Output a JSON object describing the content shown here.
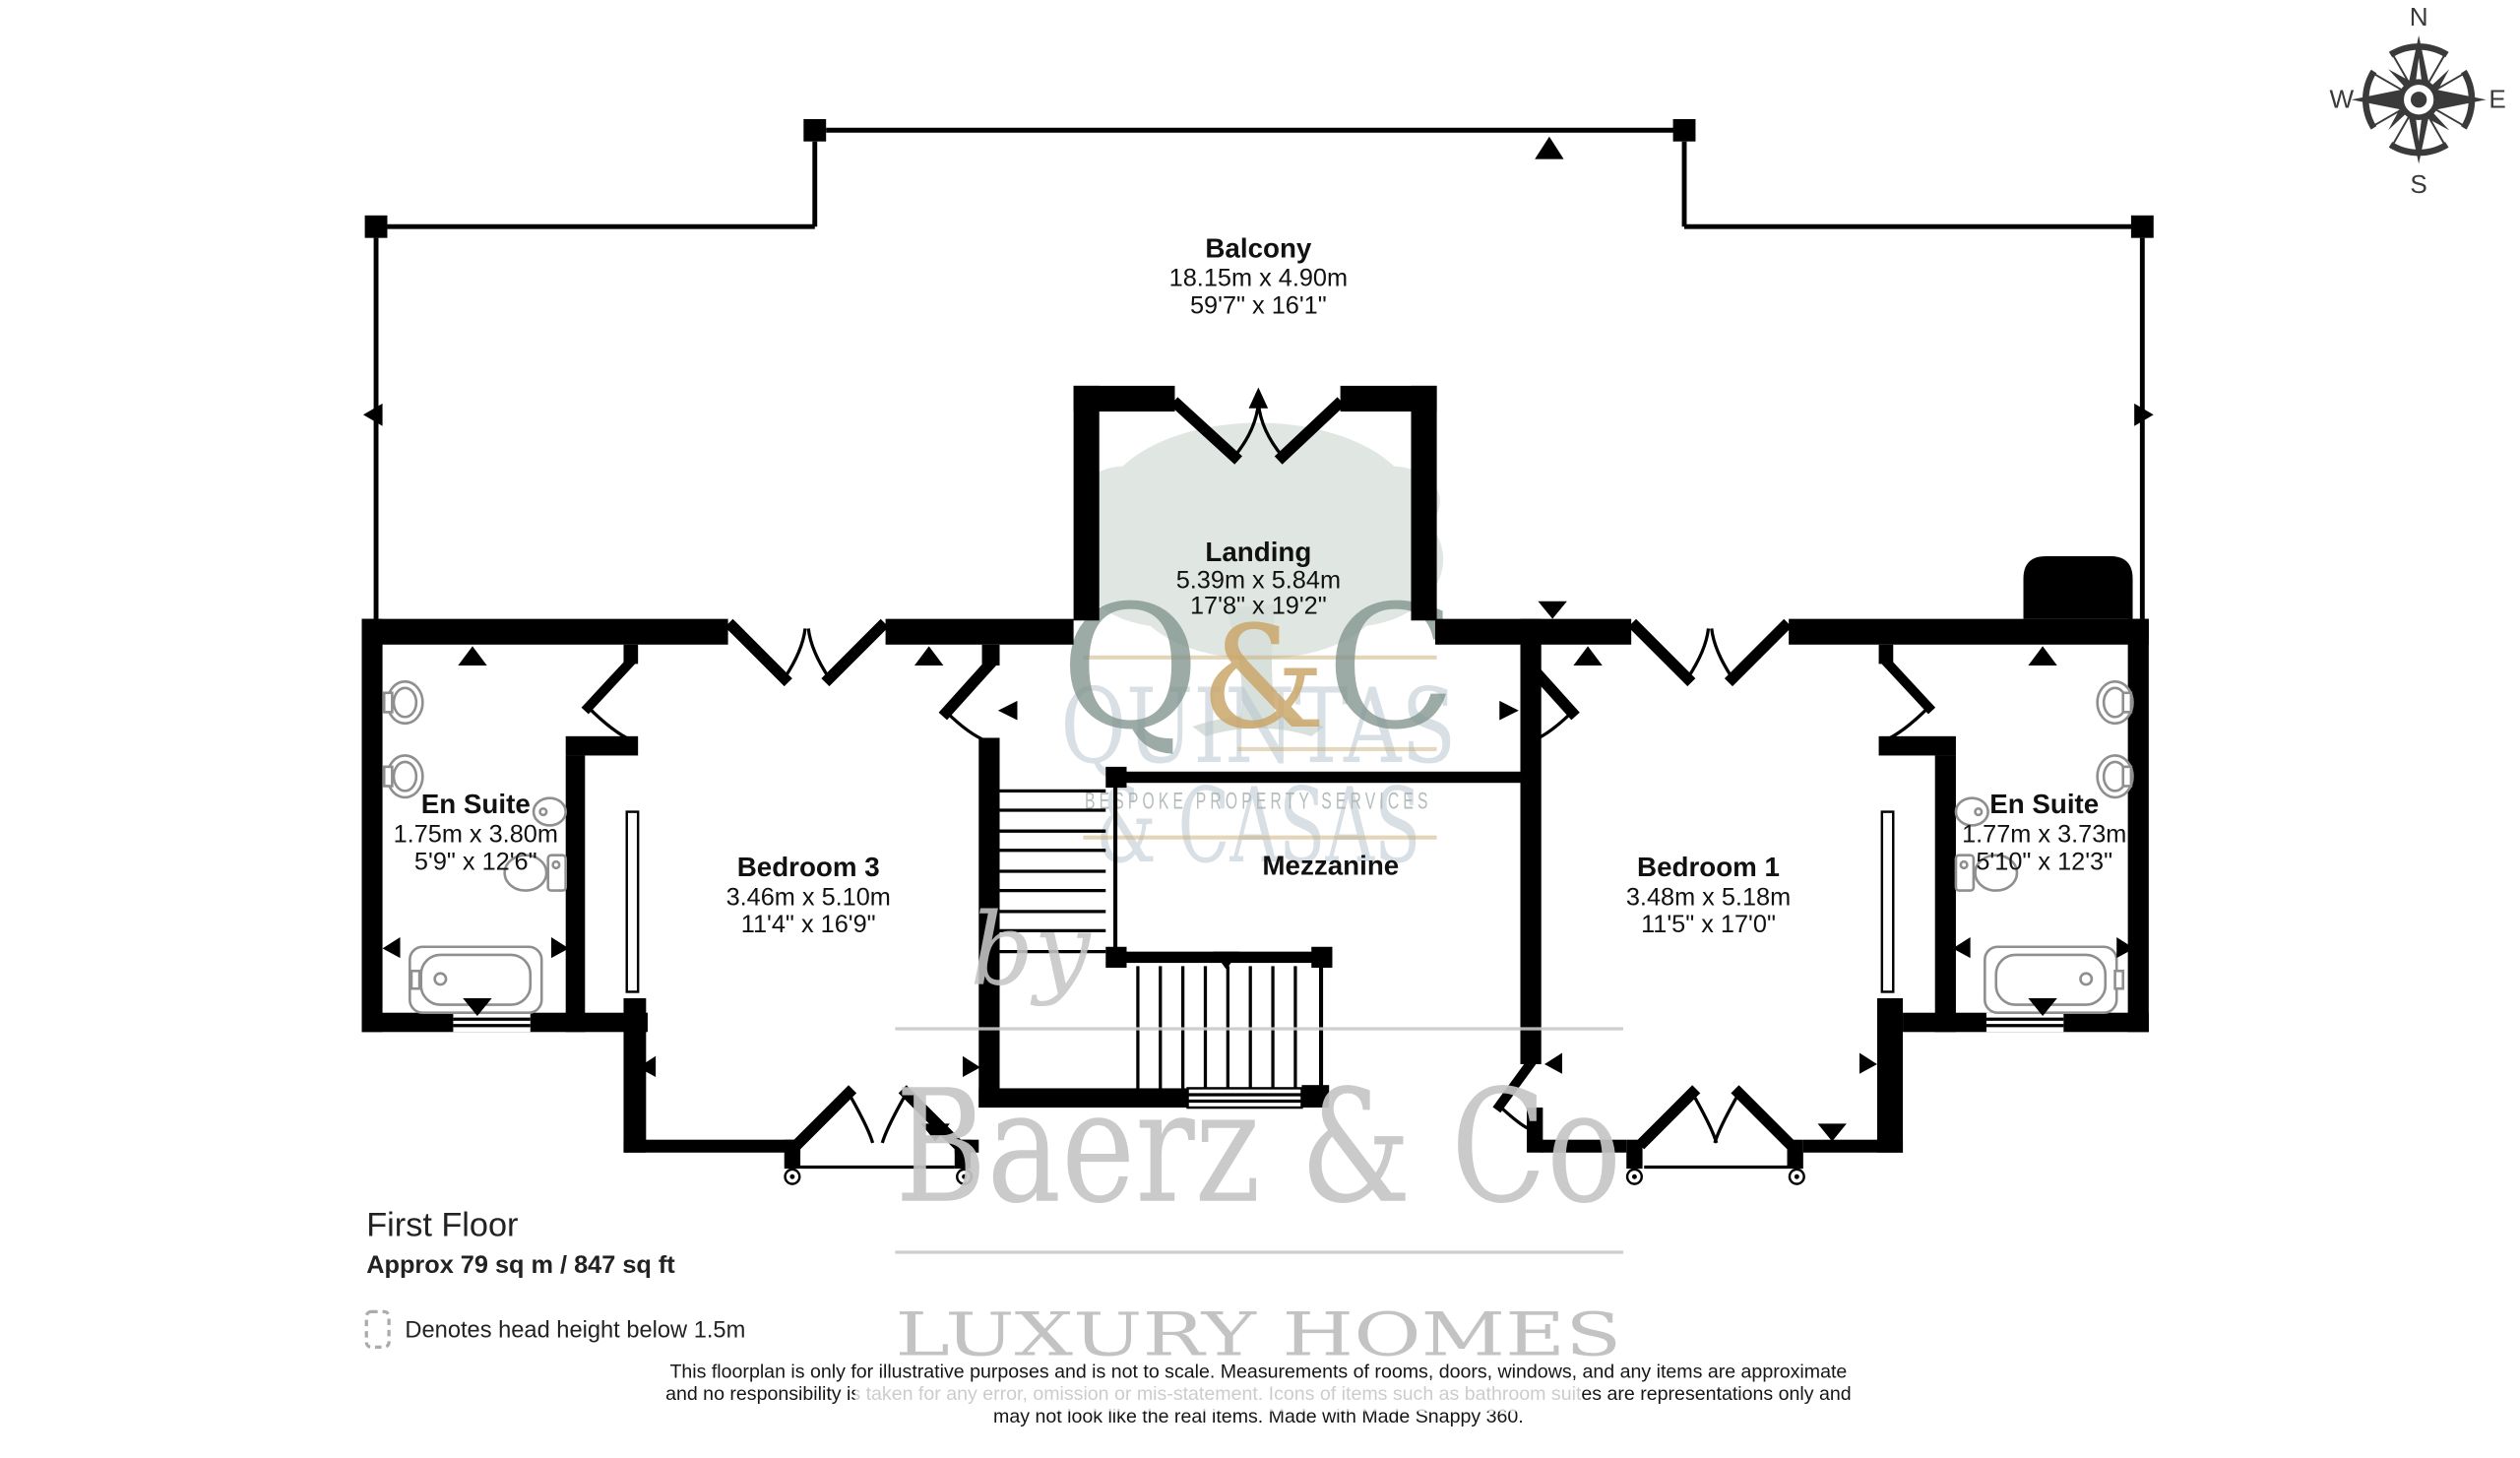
{
  "plan": {
    "title": "First Floor",
    "area": "Approx 79 sq m / 847 sq ft",
    "legend_label": "Denotes head height below 1.5m"
  },
  "compass": {
    "north": "N",
    "east": "E",
    "south": "S",
    "west": "W"
  },
  "rooms": {
    "balcony": {
      "name": "Balcony",
      "size_metric": "18.15m x 4.90m",
      "size_imperial": "59'7\" x 16'1\""
    },
    "landing": {
      "name": "Landing",
      "size_metric": "5.39m x 5.84m",
      "size_imperial": "17'8\" x 19'2\""
    },
    "bedroom3": {
      "name": "Bedroom 3",
      "size_metric": "3.46m x 5.10m",
      "size_imperial": "11'4\" x 16'9\""
    },
    "bedroom1": {
      "name": "Bedroom 1",
      "size_metric": "3.48m x 5.18m",
      "size_imperial": "11'5\" x 17'0\""
    },
    "ensuite_left": {
      "name": "En Suite",
      "size_metric": "1.75m x 3.80m",
      "size_imperial": "5'9\" x 12'6\""
    },
    "ensuite_right": {
      "name": "En Suite",
      "size_metric": "1.77m x 3.73m",
      "size_imperial": "5'10\" x 12'3\""
    },
    "mezzanine": {
      "name": "Mezzanine"
    }
  },
  "watermark": {
    "monogram_q": "Q",
    "monogram_amp": "&",
    "monogram_c": "C",
    "company_line1": "QUINTAS",
    "company_line2": "& CASAS",
    "tagline": "BESPOKE PROPERTY SERVICES",
    "by": "by",
    "brand": "Baerz & Co",
    "brand_tagline": "LUXURY HOMES"
  },
  "disclaimer": {
    "line1": "This floorplan is only for illustrative purposes and is not to scale. Measurements of rooms, doors, windows, and any items are approximate",
    "line2": "and no responsibility is taken for any error, omission or mis-statement. Icons of items such as bathroom suites are representations only and",
    "line3": "may not look like the real items. Made with Made Snappy 360."
  },
  "colors": {
    "wall": "#000000",
    "monogram_letters": "#7e9089",
    "monogram_amp": "#c7a163",
    "backdrop_blue": "#b3c2cd",
    "tree_green": "#c3cfc8",
    "watermark_gray": "#c6c6c6",
    "gold_rule": "#c9ad77"
  }
}
